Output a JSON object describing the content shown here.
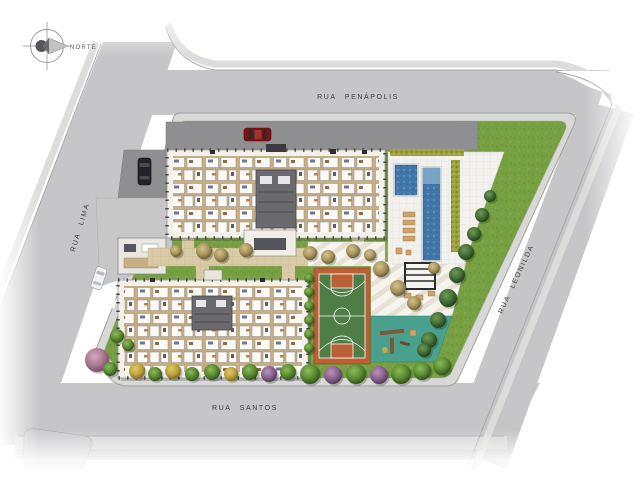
{
  "north": {
    "label": "NORTE"
  },
  "streets": {
    "penapolis": "RUA PENÁPOLIS",
    "lima": "RUA LIMA",
    "santos": "RUA SANTOS",
    "leonilda": "RUA LEONILDA"
  },
  "palette": {
    "street": "#c6c6c8",
    "sidewalk": "#d8d8d6",
    "lawn": "#76a041",
    "driveway": "#8f8f91",
    "walkway": "#d9cba5",
    "deck": "#f2f1ed",
    "pool_water": "#4177ab",
    "hedge": "#9ba23c",
    "building_floor": "#c9ae82",
    "balcony": "#f3f1ea",
    "court_green": "#4e7d45",
    "court_orange": "#bd5f35",
    "playground": "#49a08d",
    "car_red": "#7e1412",
    "car_black": "#232428",
    "car_white": "#f2f2f2"
  }
}
